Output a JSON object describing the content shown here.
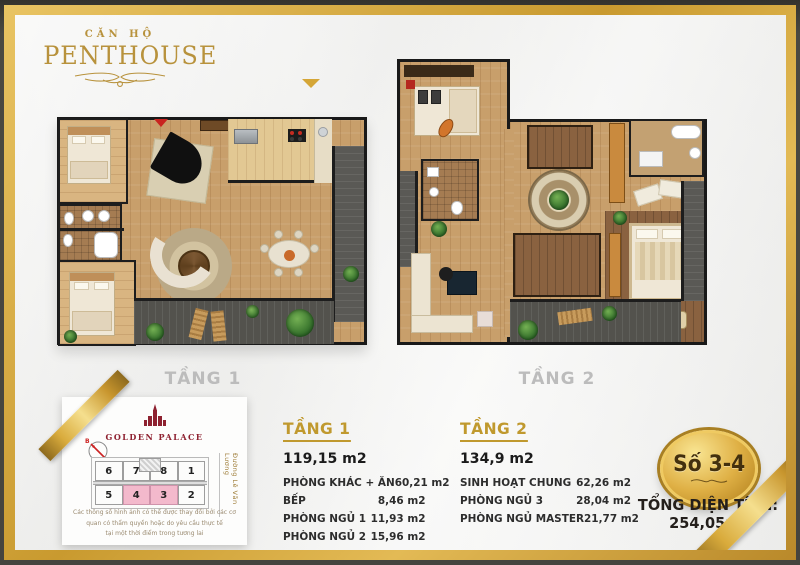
{
  "brand": {
    "small": "CĂN HỘ",
    "large": "PENTHOUSE"
  },
  "floors": {
    "floor1_label": "TẦNG 1",
    "floor2_label": "TẦNG 2"
  },
  "floor1_details": {
    "title": "TẦNG 1",
    "total_area": "119,15 m2",
    "rooms": [
      {
        "name": "PHÒNG KHÁC + ĂN",
        "area": "60,21 m2"
      },
      {
        "name": "BẾP",
        "area": "8,46 m2"
      },
      {
        "name": "PHÒNG NGỦ 1",
        "area": "11,93 m2"
      },
      {
        "name": "PHÒNG NGỦ 2",
        "area": "15,96 m2"
      }
    ]
  },
  "floor2_details": {
    "title": "TẦNG 2",
    "total_area": "134,9 m2",
    "rooms": [
      {
        "name": "SINH HOẠT CHUNG",
        "area": "62,26 m2"
      },
      {
        "name": "PHÒNG NGỦ 3",
        "area": "28,04 m2"
      },
      {
        "name": "PHÒNG NGỦ MASTER",
        "area": "21,77 m2"
      }
    ]
  },
  "summary": {
    "unit_badge": "Số 3-4",
    "total_area_line": "TỔNG DIỆN TÍCH: 254,05m²"
  },
  "info_card": {
    "project_name": "GOLDEN PALACE",
    "compass_label": "B",
    "street_label": "Đường Lê Văn Lương",
    "units_top": [
      "6",
      "7",
      "8",
      "1"
    ],
    "units_bottom": [
      "5",
      "4",
      "3",
      "2"
    ],
    "highlighted_units": [
      "4",
      "3"
    ],
    "disclaimer_line1": "Các thông số hình ảnh có thể được thay đổi bởi các cơ quan có thẩm quyền hoặc do yêu cầu thực tế",
    "disclaimer_line2": "tại một thời điểm trong tương lai"
  },
  "colors": {
    "accent_gold": "#d0a13c",
    "brand_red": "#8e2130",
    "highlight_pink": "#f3b9cc",
    "floor_label_gray": "#bcbcbc"
  }
}
